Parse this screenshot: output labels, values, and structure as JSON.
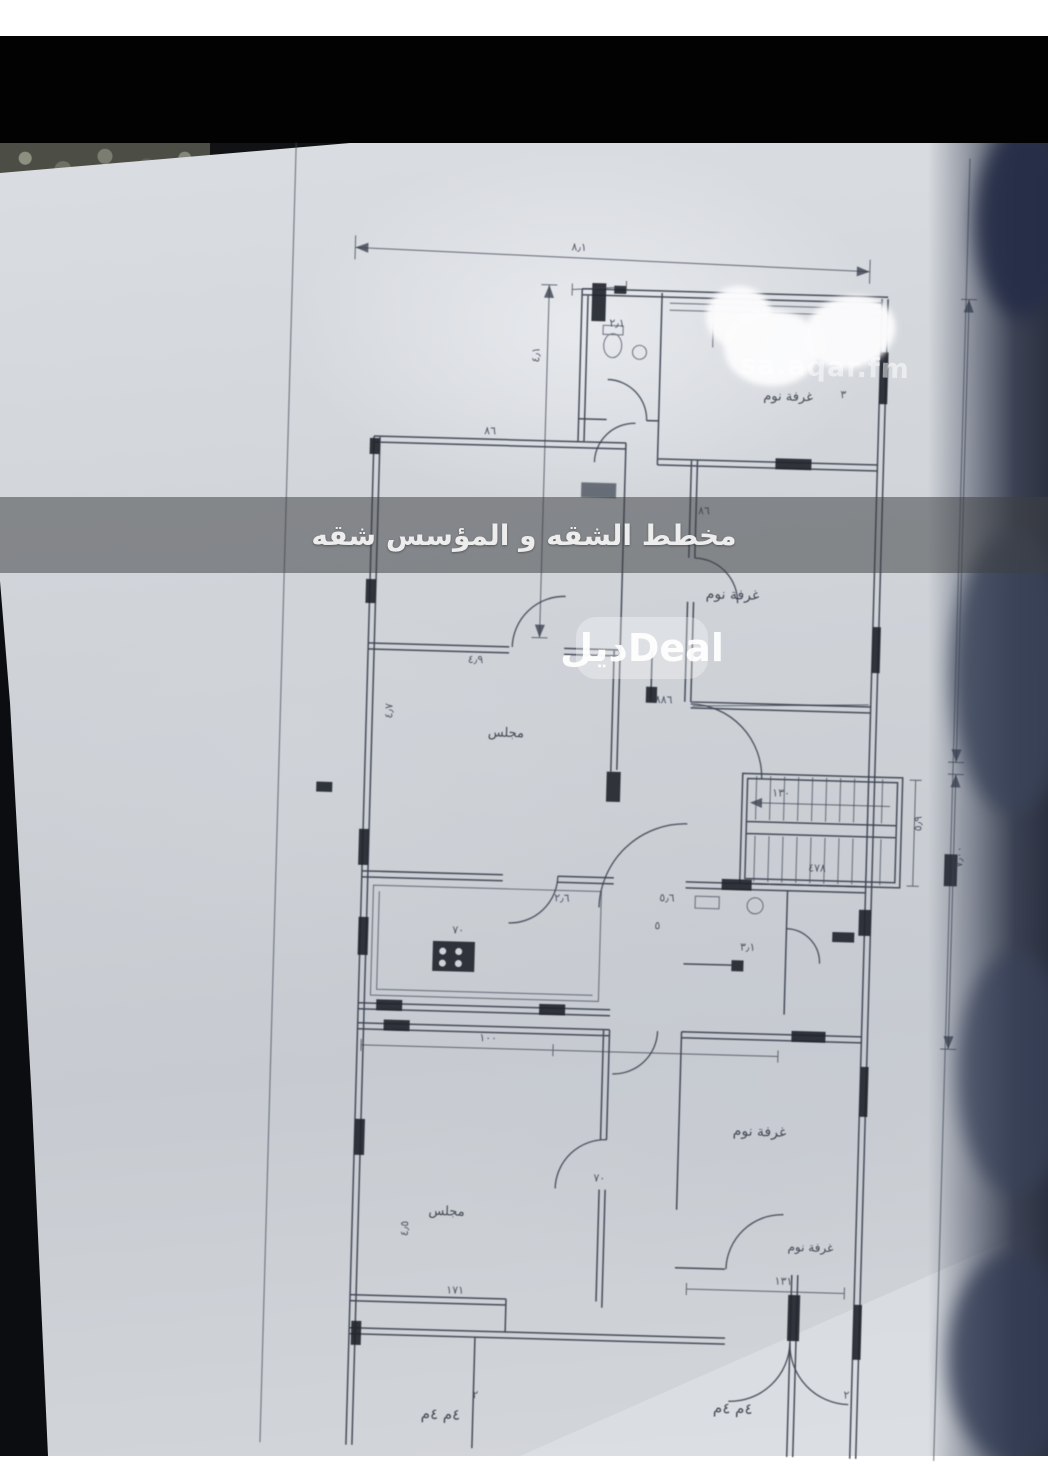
{
  "image_type": "photo of an architectural floor-plan sheet",
  "overlays": {
    "banner": {
      "text": "مخطط الشقه و المؤسس شقه",
      "bg": "rgba(62,64,66,0.53)",
      "text_color": "#ededed"
    },
    "deal_watermark": {
      "text": "ديلDeal"
    },
    "site_watermark": {
      "text": "sa.aqar.fm"
    }
  },
  "palette": {
    "paper": "#ccd0d5",
    "ink": "#39404e",
    "top_band": "#020203",
    "right_shadow": "#37405a",
    "page_margin": "#ffffff"
  },
  "floor_plan": {
    "room_labels": [
      {
        "text": "غرفة نوم",
        "x": 752,
        "y": 396,
        "s": 13
      },
      {
        "text": "غرفة نوم",
        "x": 700,
        "y": 596,
        "s": 14
      },
      {
        "text": "مجلس",
        "x": 486,
        "y": 740,
        "s": 13
      },
      {
        "text": "غرفة نوم",
        "x": 742,
        "y": 1132,
        "s": 14
      },
      {
        "text": "مجلس",
        "x": 440,
        "y": 1220,
        "s": 13
      },
      {
        "text": "غرفة نوم",
        "x": 800,
        "y": 1246,
        "s": 12
      }
    ],
    "dimension_labels": [
      {
        "text": "٨٫١",
        "x": 556,
        "y": 252
      },
      {
        "text": "٤٫١",
        "x": 527,
        "y": 365,
        "r": -90
      },
      {
        "text": "٢٫١",
        "x": 596,
        "y": 327
      },
      {
        "text": "٨٦",
        "x": 474,
        "y": 438
      },
      {
        "text": "٨٦",
        "x": 690,
        "y": 512
      },
      {
        "text": "٤٫٩",
        "x": 464,
        "y": 667
      },
      {
        "text": "٤٫٧",
        "x": 390,
        "y": 725,
        "r": -90
      },
      {
        "text": "٨٨٦",
        "x": 652,
        "y": 702
      },
      {
        "text": "١٣٠",
        "x": 772,
        "y": 792
      },
      {
        "text": "٤٧٨",
        "x": 810,
        "y": 866
      },
      {
        "text": "٥٫٩",
        "x": 922,
        "y": 823,
        "r": -90
      },
      {
        "text": "٧٫٠٠",
        "x": 964,
        "y": 858,
        "r": -90
      },
      {
        "text": "٢٫٦",
        "x": 557,
        "y": 903
      },
      {
        "text": "٥٫٦",
        "x": 662,
        "y": 900
      },
      {
        "text": "٧٠",
        "x": 456,
        "y": 938
      },
      {
        "text": "٥",
        "x": 658,
        "y": 928
      },
      {
        "text": "٣٫١",
        "x": 744,
        "y": 947
      },
      {
        "text": "١٠٠",
        "x": 486,
        "y": 1045
      },
      {
        "text": "٣",
        "x": 829,
        "y": 392
      },
      {
        "text": "١٧١",
        "x": 460,
        "y": 1298
      },
      {
        "text": "١٣١",
        "x": 788,
        "y": 1280
      },
      {
        "text": "٤٫٥",
        "x": 420,
        "y": 1242,
        "r": -90
      },
      {
        "text": "٧٠",
        "x": 604,
        "y": 1182
      },
      {
        "text": "٢",
        "x": 489,
        "y": 1402
      },
      {
        "text": "٢",
        "x": 860,
        "y": 1392
      }
    ],
    "bottom_notes": [
      {
        "text": "٤م ٤م",
        "x": 438,
        "y": 1424,
        "s": 15
      },
      {
        "text": "٤م ٤م",
        "x": 730,
        "y": 1410,
        "s": 15
      }
    ]
  }
}
